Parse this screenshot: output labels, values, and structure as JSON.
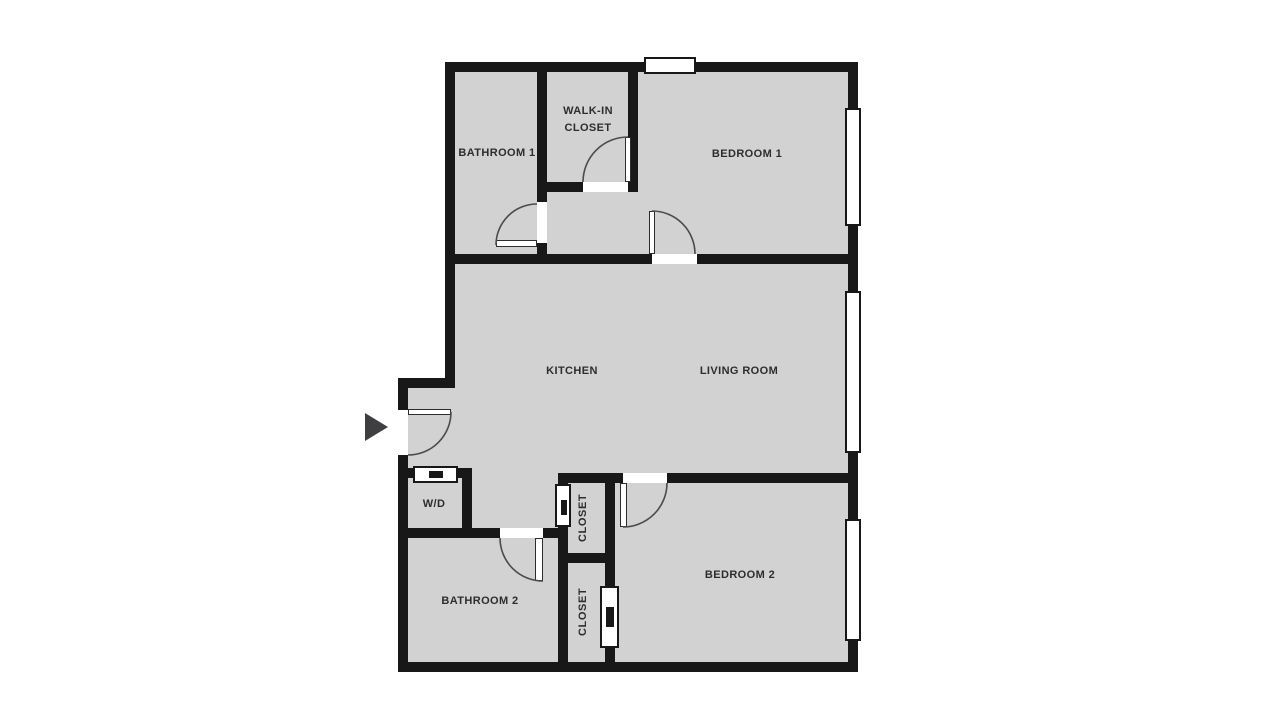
{
  "title": "apartment-floor-plan",
  "colors": {
    "wall": "#181818",
    "floor": "#d2d2d2",
    "background": "#ffffff",
    "label_text": "#2d2d2d",
    "door_arc": "#4b4b4b",
    "entrance_arrow": "#3f3f42"
  },
  "rooms": {
    "bathroom_1": {
      "label": "BATHROOM 1"
    },
    "walk_in_closet": {
      "label": "WALK-IN CLOSET"
    },
    "bedroom_1": {
      "label": "BEDROOM 1"
    },
    "kitchen": {
      "label": "KITCHEN"
    },
    "living_room": {
      "label": "LIVING ROOM"
    },
    "laundry": {
      "label": "W/D"
    },
    "closet_upper": {
      "label": "CLOSET"
    },
    "closet_lower": {
      "label": "CLOSET"
    },
    "bathroom_2": {
      "label": "BATHROOM 2"
    },
    "bedroom_2": {
      "label": "BEDROOM 2"
    }
  },
  "features": {
    "entrance_marker": "right-pointing triangle at main entry door",
    "windows": [
      "top wall (bedroom 1)",
      "right wall (bedroom 1)",
      "right wall (living room)",
      "right wall (bedroom 2)"
    ],
    "sliding_doors": [
      "W/D closet",
      "upper hallway closet",
      "lower closet (bedroom 2 side)"
    ]
  }
}
